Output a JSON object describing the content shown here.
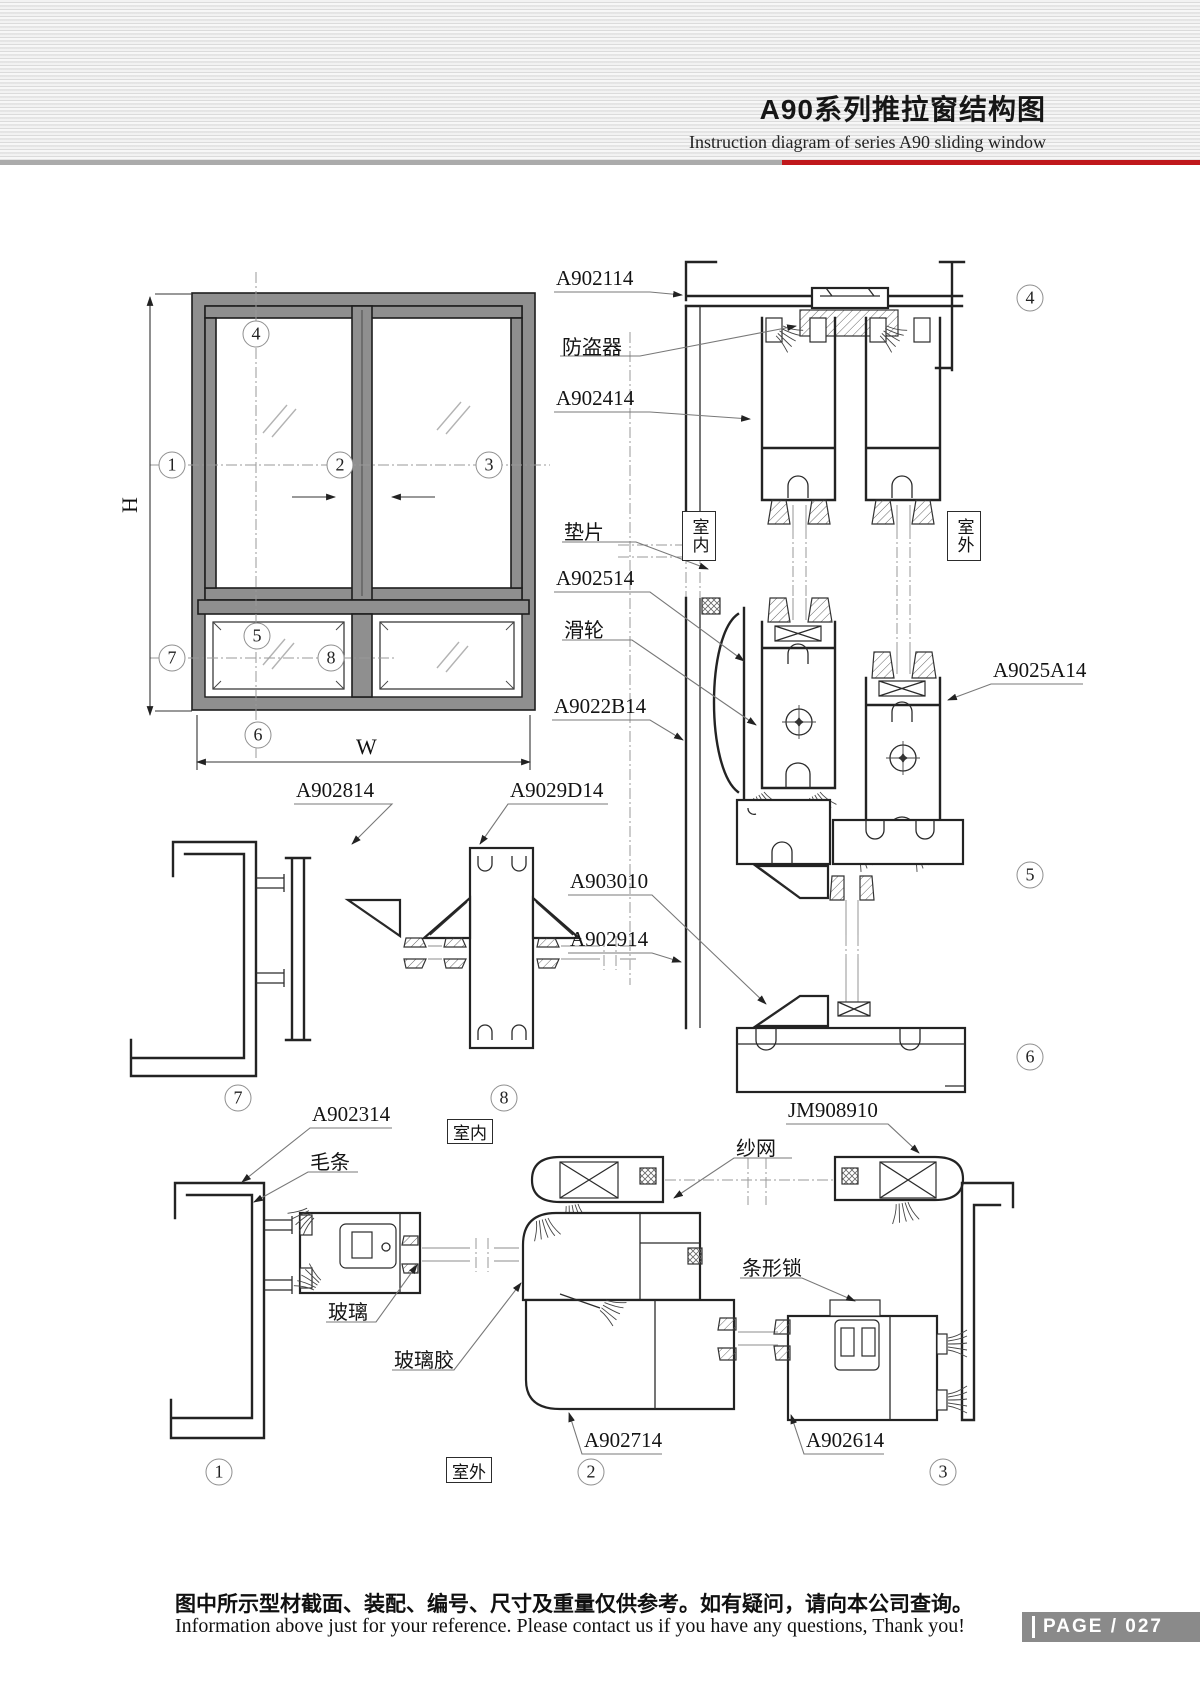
{
  "header": {
    "title_cn": "A90系列推拉窗结构图",
    "title_en": "Instruction diagram of series A90 sliding window"
  },
  "dims": {
    "height": "H",
    "width": "W"
  },
  "callouts": {
    "c1": "1",
    "c2": "2",
    "c3": "3",
    "c4": "4",
    "c5": "5",
    "c6": "6",
    "c7": "7",
    "c8": "8"
  },
  "room": {
    "indoor": "室内",
    "outdoor": "室外"
  },
  "parts": {
    "a902114": "A902114",
    "fangdaoqi": "防盗器",
    "a902414": "A902414",
    "dianpian": "垫片",
    "a902514": "A902514",
    "hualun": "滑轮",
    "a9025a14": "A9025A14",
    "a9022b14": "A9022B14",
    "a902814": "A902814",
    "a9029d14": "A9029D14",
    "a903010": "A903010",
    "a902914": "A902914",
    "a902314": "A902314",
    "maotiao": "毛条",
    "boli": "玻璃",
    "bolijiao": "玻璃胶",
    "shawang": "纱网",
    "jm908910": "JM908910",
    "tiaoxingsuo": "条形锁",
    "a902714": "A902714",
    "a902614": "A902614"
  },
  "footer": {
    "note_cn": "图中所示型材截面、装配、编号、尺寸及重量仅供参考。如有疑问，请向本公司查询。",
    "note_en": "Information above just for your reference. Please contact us if you have any questions, Thank you!",
    "page_label": "PAGE",
    "page_number": "027"
  }
}
